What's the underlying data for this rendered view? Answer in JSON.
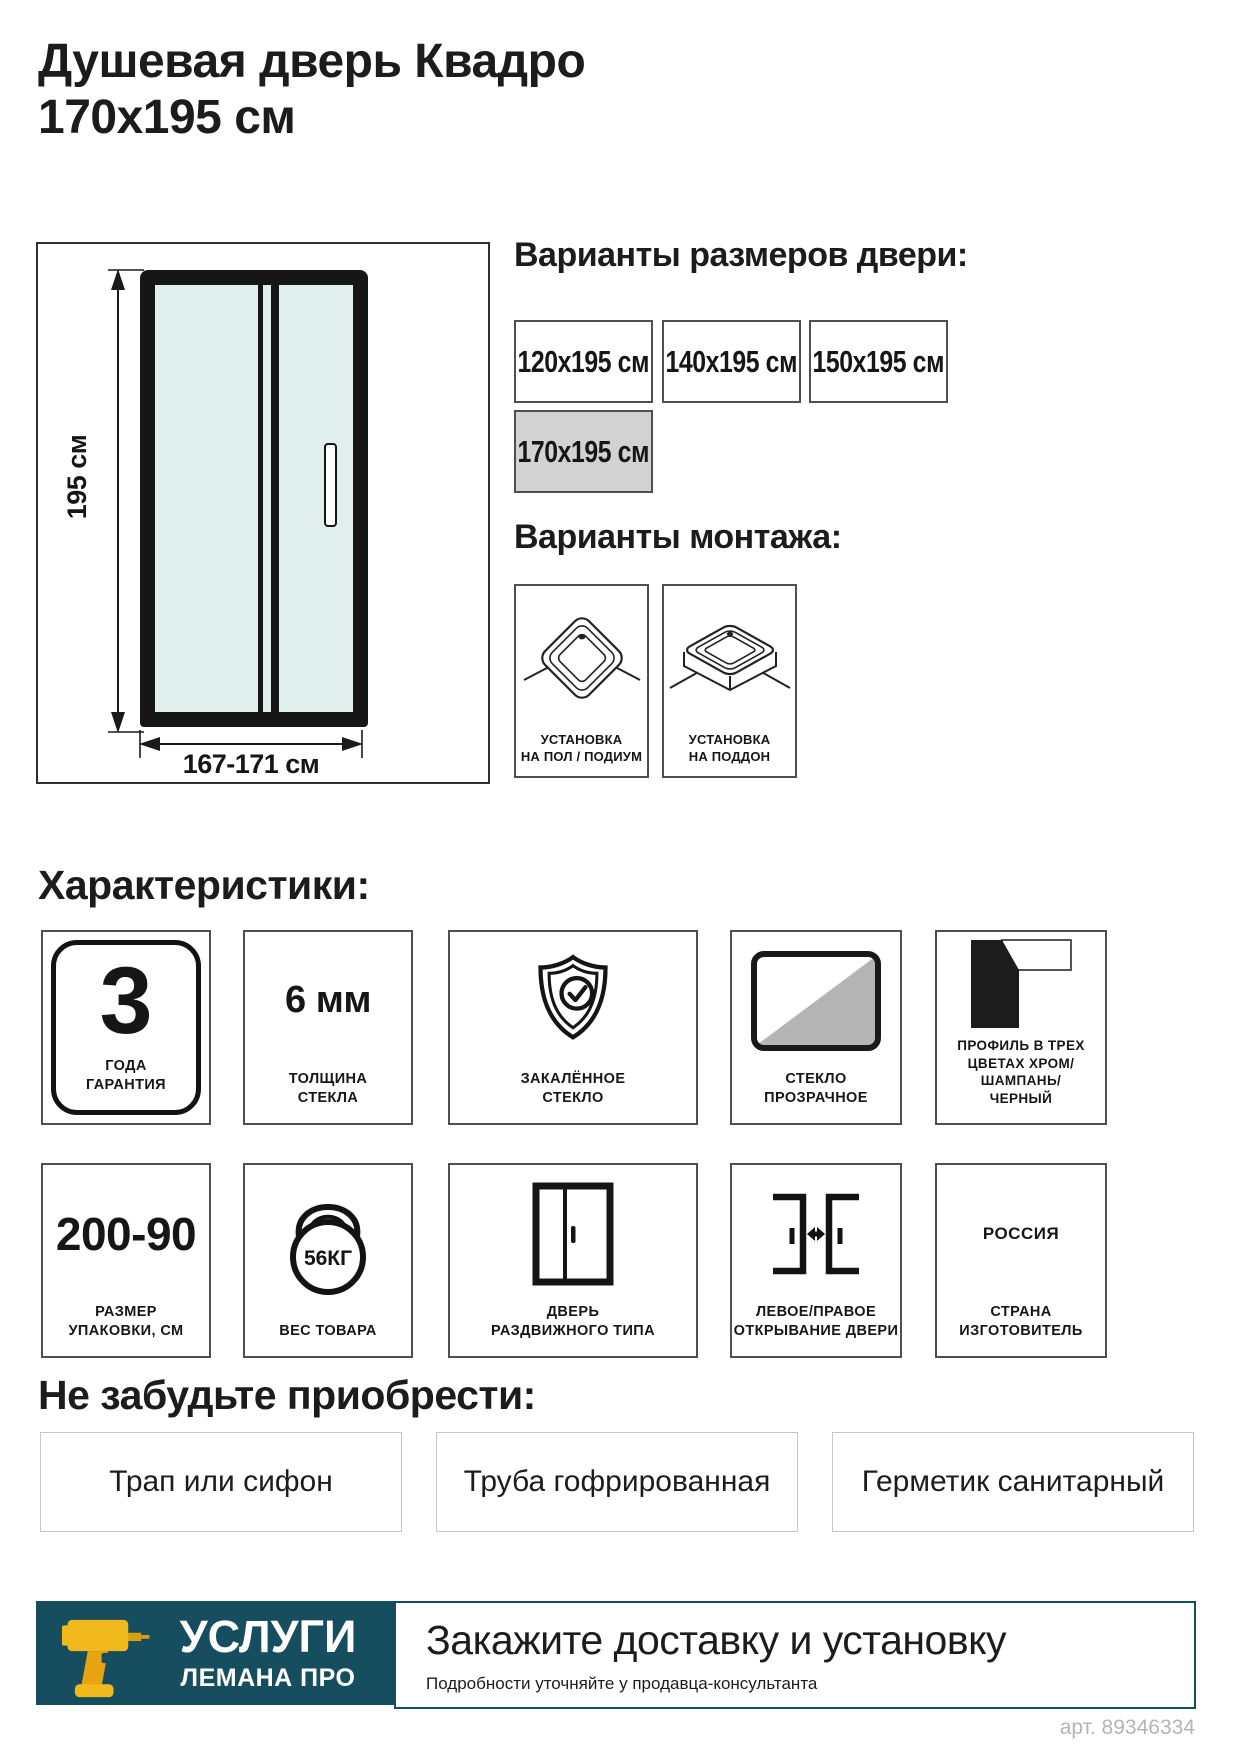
{
  "title": "Душевая дверь Квадро\n170х195 см",
  "art_number": "арт. 89346334",
  "diagram": {
    "height_label": "195 см",
    "width_label": "167-171 см"
  },
  "sizes": {
    "heading": "Варианты размеров двери:",
    "options": [
      {
        "label": "120х195 см",
        "selected": false
      },
      {
        "label": "140х195 см",
        "selected": false
      },
      {
        "label": "150х195 см",
        "selected": false
      },
      {
        "label": "170х195 см",
        "selected": true
      }
    ]
  },
  "mounting": {
    "heading": "Варианты монтажа:",
    "options": [
      {
        "label": "УСТАНОВКА\nНА ПОЛ / ПОДИУМ",
        "icon": "floor-podium-tray-icon"
      },
      {
        "label": "УСТАНОВКА\nНА ПОДДОН",
        "icon": "shower-tray-icon"
      }
    ]
  },
  "characteristics": {
    "heading": "Характеристики:",
    "row1": [
      {
        "value": "3",
        "label": "ГОДА\nГАРАНТИЯ",
        "icon": "warranty-badge-icon"
      },
      {
        "value": "6 мм",
        "label": "ТОЛЩИНА\nСТЕКЛА"
      },
      {
        "label": "ЗАКАЛЁННОЕ\nСТЕКЛО",
        "icon": "shield-check-icon"
      },
      {
        "label": "СТЕКЛО\nПРОЗРАЧНОЕ",
        "icon": "transparent-glass-icon"
      },
      {
        "label": "ПРОФИЛЬ В ТРЕХ\nЦВЕТАХ ХРОМ/ШАМПАНЬ/\nЧЕРНЫЙ",
        "icon": "profile-corner-icon"
      }
    ],
    "row2": [
      {
        "value": "200-90",
        "label": "РАЗМЕР\nУПАКОВКИ, СМ"
      },
      {
        "value": "56КГ",
        "label": "ВЕС ТОВАРА",
        "icon": "kettlebell-icon"
      },
      {
        "label": "ДВЕРЬ\nРАЗДВИЖНОГО ТИПА",
        "icon": "sliding-door-icon"
      },
      {
        "label": "ЛЕВОЕ/ПРАВОЕ\nОТКРЫВАНИЕ ДВЕРИ",
        "icon": "left-right-opening-icon"
      },
      {
        "value": "РОССИЯ",
        "label": "СТРАНА\nИЗГОТОВИТЕЛЬ"
      }
    ]
  },
  "upsell": {
    "heading": "Не забудьте приобрести:",
    "items": [
      "Трап или сифон",
      "Труба гофрированная",
      "Герметик санитарный"
    ]
  },
  "footer": {
    "services_title": "УСЛУГИ",
    "services_brand": "ЛЕМАНА ПРО",
    "cta_title": "Закажите доставку и установку",
    "cta_note": "Подробности уточняйте у продавца-консультанта"
  },
  "colors": {
    "teal": "#174e5f",
    "selected_size_bg": "#d2d2d2",
    "glass": "#e0efec",
    "drill_yellow": "#f2b91c",
    "art_text": "#b4b4b4"
  }
}
